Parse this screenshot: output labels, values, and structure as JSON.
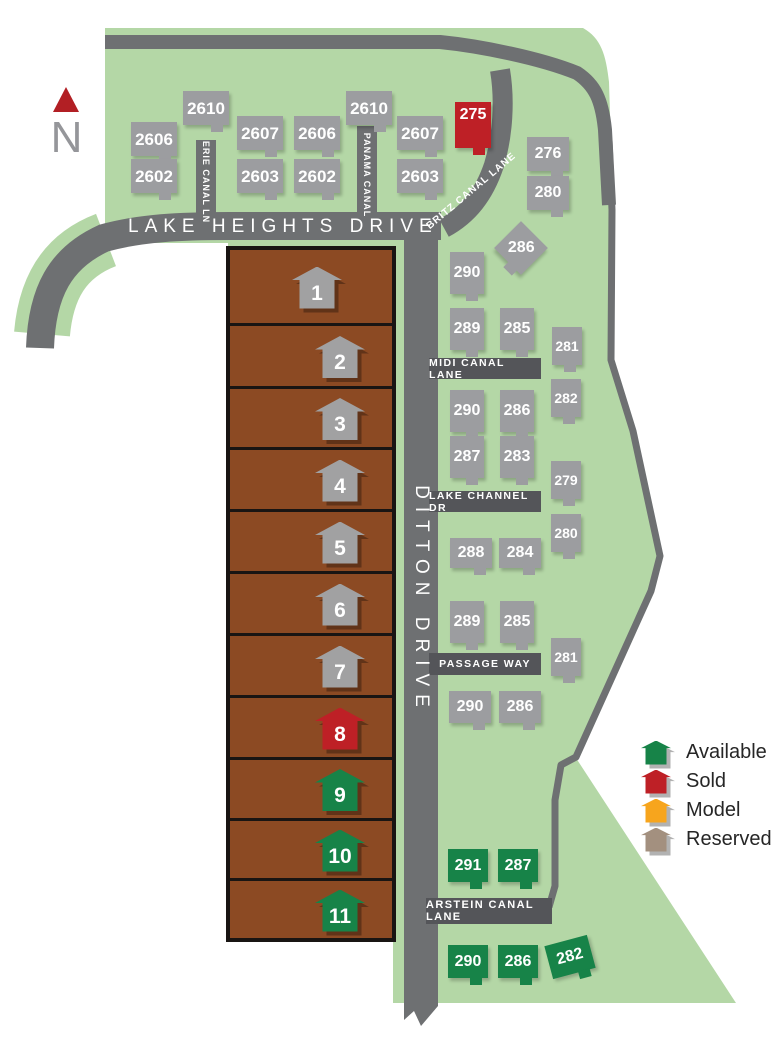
{
  "north": {
    "label": "N"
  },
  "streets": {
    "lake_heights": "LAKE HEIGHTS DRIVE",
    "ditton": "DITTON DRIVE",
    "erie": "ERIE CANAL LN",
    "panama": "PANAMA CANAL",
    "britz": "BRITZ CANAL LANE",
    "midi": "MIDI CANAL LANE",
    "lake_channel": "LAKE CHANNEL DR",
    "passage": "PASSAGE WAY",
    "arstein": "ARSTEIN CANAL LANE"
  },
  "colors": {
    "map_green": "#b4d7a6",
    "road": "#6e7072",
    "road_label_bar": "#545559",
    "marker_gray": "#9c9da0",
    "available": "#178348",
    "sold": "#be2026",
    "model": "#f7a51d",
    "reserved": "#a3907f",
    "lot_brown": "#8c4a23",
    "lot_border": "#191513",
    "north_red": "#b21f24",
    "lot_house_gray": "#a1a1a2"
  },
  "legend": {
    "items": [
      {
        "label": "Available",
        "key": "available"
      },
      {
        "label": "Sold",
        "key": "sold"
      },
      {
        "label": "Model",
        "key": "model"
      },
      {
        "label": "Reserved",
        "key": "reserved"
      }
    ]
  },
  "lots": [
    {
      "num": "1",
      "status": "reserved",
      "top": 250,
      "height": 73,
      "icon_x": 317
    },
    {
      "num": "2",
      "status": "reserved",
      "top": 326,
      "height": 60,
      "icon_x": 340
    },
    {
      "num": "3",
      "status": "reserved",
      "top": 389,
      "height": 58,
      "icon_x": 340
    },
    {
      "num": "4",
      "status": "reserved",
      "top": 450,
      "height": 59,
      "icon_x": 340
    },
    {
      "num": "5",
      "status": "reserved",
      "top": 512,
      "height": 59,
      "icon_x": 340
    },
    {
      "num": "6",
      "status": "reserved",
      "top": 574,
      "height": 59,
      "icon_x": 340
    },
    {
      "num": "7",
      "status": "reserved",
      "top": 636,
      "height": 59,
      "icon_x": 340
    },
    {
      "num": "8",
      "status": "sold",
      "top": 698,
      "height": 59,
      "icon_x": 340
    },
    {
      "num": "9",
      "status": "available",
      "top": 760,
      "height": 58,
      "icon_x": 340
    },
    {
      "num": "10",
      "status": "available",
      "top": 821,
      "height": 57,
      "icon_x": 340
    },
    {
      "num": "11",
      "status": "available",
      "top": 881,
      "height": 57,
      "icon_x": 340
    }
  ],
  "homes": [
    {
      "label": "2610",
      "x": 183,
      "y": 91,
      "w": 46,
      "h": 34,
      "status": "gray"
    },
    {
      "label": "2606",
      "x": 131,
      "y": 122,
      "w": 46,
      "h": 34,
      "status": "gray"
    },
    {
      "label": "2602",
      "x": 131,
      "y": 159,
      "w": 46,
      "h": 34,
      "status": "gray"
    },
    {
      "label": "2607",
      "x": 237,
      "y": 116,
      "w": 46,
      "h": 34,
      "status": "gray"
    },
    {
      "label": "2603",
      "x": 237,
      "y": 159,
      "w": 46,
      "h": 34,
      "status": "gray"
    },
    {
      "label": "2606",
      "x": 294,
      "y": 116,
      "w": 46,
      "h": 34,
      "status": "gray"
    },
    {
      "label": "2602",
      "x": 294,
      "y": 159,
      "w": 46,
      "h": 34,
      "status": "gray"
    },
    {
      "label": "2610",
      "x": 346,
      "y": 91,
      "w": 46,
      "h": 34,
      "status": "gray"
    },
    {
      "label": "2607",
      "x": 397,
      "y": 116,
      "w": 46,
      "h": 34,
      "status": "gray"
    },
    {
      "label": "2603",
      "x": 397,
      "y": 159,
      "w": 46,
      "h": 34,
      "status": "gray"
    },
    {
      "label": "275",
      "x": 455,
      "y": 102,
      "w": 36,
      "h": 46,
      "status": "sold",
      "text_top": true
    },
    {
      "label": "276",
      "x": 527,
      "y": 137,
      "w": 42,
      "h": 34,
      "status": "gray"
    },
    {
      "label": "280",
      "x": 527,
      "y": 176,
      "w": 42,
      "h": 34,
      "status": "gray"
    },
    {
      "label": "286",
      "x": 502,
      "y": 229,
      "w": 38,
      "h": 38,
      "status": "gray",
      "rot": 45,
      "text_horizontal": true
    },
    {
      "label": "290",
      "x": 450,
      "y": 252,
      "w": 34,
      "h": 42,
      "status": "gray"
    },
    {
      "label": "289",
      "x": 450,
      "y": 308,
      "w": 34,
      "h": 42,
      "status": "gray"
    },
    {
      "label": "285",
      "x": 500,
      "y": 308,
      "w": 34,
      "h": 42,
      "status": "gray"
    },
    {
      "label": "281",
      "x": 552,
      "y": 327,
      "w": 30,
      "h": 38,
      "status": "gray"
    },
    {
      "label": "290",
      "x": 450,
      "y": 390,
      "w": 34,
      "h": 42,
      "status": "gray"
    },
    {
      "label": "286",
      "x": 500,
      "y": 390,
      "w": 34,
      "h": 42,
      "status": "gray"
    },
    {
      "label": "282",
      "x": 551,
      "y": 379,
      "w": 30,
      "h": 38,
      "status": "gray"
    },
    {
      "label": "287",
      "x": 450,
      "y": 436,
      "w": 34,
      "h": 42,
      "status": "gray"
    },
    {
      "label": "283",
      "x": 500,
      "y": 436,
      "w": 34,
      "h": 42,
      "status": "gray"
    },
    {
      "label": "279",
      "x": 551,
      "y": 461,
      "w": 30,
      "h": 38,
      "status": "gray"
    },
    {
      "label": "280",
      "x": 551,
      "y": 514,
      "w": 30,
      "h": 38,
      "status": "gray"
    },
    {
      "label": "288",
      "x": 450,
      "y": 538,
      "w": 42,
      "h": 30,
      "status": "gray"
    },
    {
      "label": "284",
      "x": 499,
      "y": 538,
      "w": 42,
      "h": 30,
      "status": "gray"
    },
    {
      "label": "289",
      "x": 450,
      "y": 601,
      "w": 34,
      "h": 42,
      "status": "gray"
    },
    {
      "label": "285",
      "x": 500,
      "y": 601,
      "w": 34,
      "h": 42,
      "status": "gray"
    },
    {
      "label": "281",
      "x": 551,
      "y": 638,
      "w": 30,
      "h": 38,
      "status": "gray"
    },
    {
      "label": "290",
      "x": 449,
      "y": 691,
      "w": 42,
      "h": 32,
      "status": "gray"
    },
    {
      "label": "286",
      "x": 499,
      "y": 691,
      "w": 42,
      "h": 32,
      "status": "gray"
    },
    {
      "label": "291",
      "x": 448,
      "y": 849,
      "w": 40,
      "h": 33,
      "status": "available"
    },
    {
      "label": "287",
      "x": 498,
      "y": 849,
      "w": 40,
      "h": 33,
      "status": "available"
    },
    {
      "label": "290",
      "x": 448,
      "y": 945,
      "w": 40,
      "h": 33,
      "status": "available"
    },
    {
      "label": "286",
      "x": 498,
      "y": 945,
      "w": 40,
      "h": 33,
      "status": "available"
    },
    {
      "label": "282",
      "x": 548,
      "y": 940,
      "w": 44,
      "h": 34,
      "status": "available",
      "rot": -15
    }
  ]
}
